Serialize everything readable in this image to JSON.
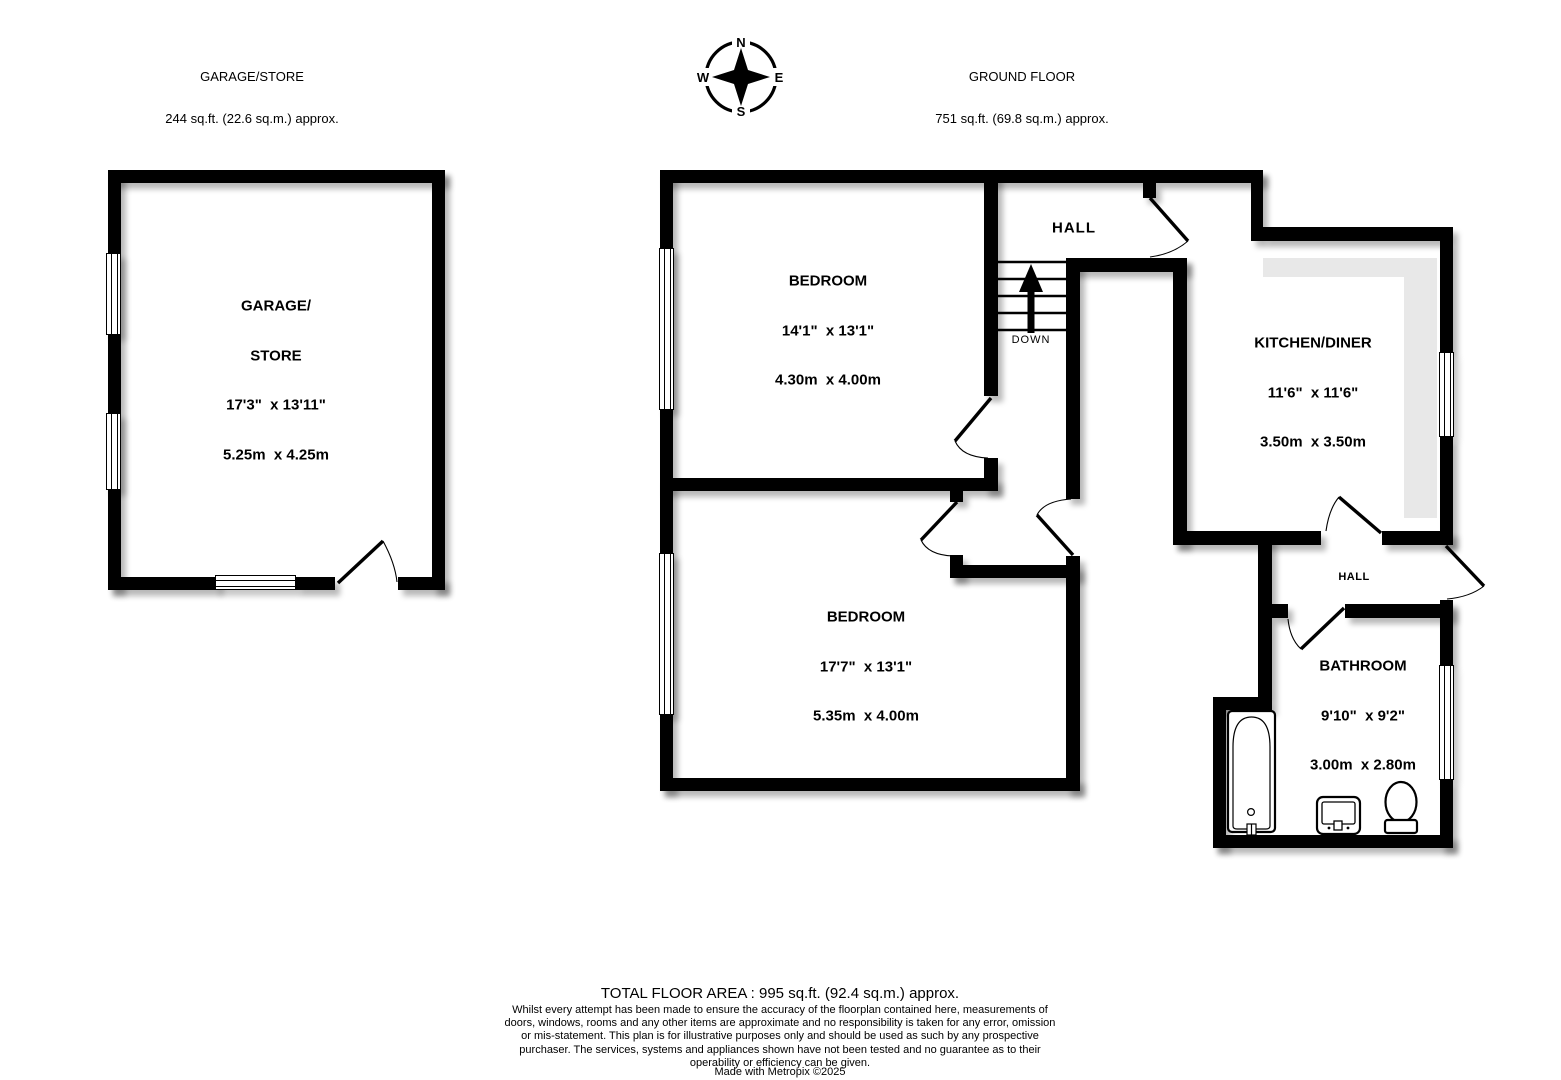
{
  "header": {
    "garage_title": "GARAGE/STORE",
    "garage_area": "244 sq.ft. (22.6 sq.m.) approx.",
    "floor_title": "GROUND FLOOR",
    "floor_area": "751 sq.ft. (69.8 sq.m.) approx."
  },
  "compass": {
    "n": "N",
    "e": "E",
    "s": "S",
    "w": "W"
  },
  "rooms": {
    "garage": {
      "l1": "GARAGE/",
      "l2": "STORE",
      "imp": "17'3\"  x 13'11\"",
      "met": "5.25m  x 4.25m"
    },
    "bedroom1": {
      "l1": "BEDROOM",
      "imp": "14'1\"  x 13'1\"",
      "met": "4.30m  x 4.00m"
    },
    "bedroom2": {
      "l1": "BEDROOM",
      "imp": "17'7\"  x 13'1\"",
      "met": "5.35m  x 4.00m"
    },
    "kitchen": {
      "l1": "KITCHEN/DINER",
      "imp": "11'6\"  x 11'6\"",
      "met": "3.50m  x 3.50m"
    },
    "bathroom": {
      "l1": "BATHROOM",
      "imp": "9'10\"  x 9'2\"",
      "met": "3.00m  x 2.80m"
    }
  },
  "labels": {
    "hall_upper": "HALL",
    "hall_lower": "HALL",
    "stairs_direction": "DOWN"
  },
  "footer": {
    "total": "TOTAL FLOOR AREA : 995 sq.ft. (92.4 sq.m.) approx.",
    "disclaimer": "Whilst every attempt has been made to ensure the accuracy of the floorplan contained here, measurements of doors, windows, rooms and any other items are approximate and no responsibility is taken for any error, omission or mis-statement. This plan is for illustrative purposes only and should be used as such by any prospective purchaser. The services, systems and appliances shown have not been tested and no guarantee as to their operability or efficiency can be given.",
    "credit": "Made with Metropix ©2025"
  },
  "colors": {
    "wall": "#000000",
    "counter": "#e8e8e8",
    "background": "#ffffff"
  }
}
